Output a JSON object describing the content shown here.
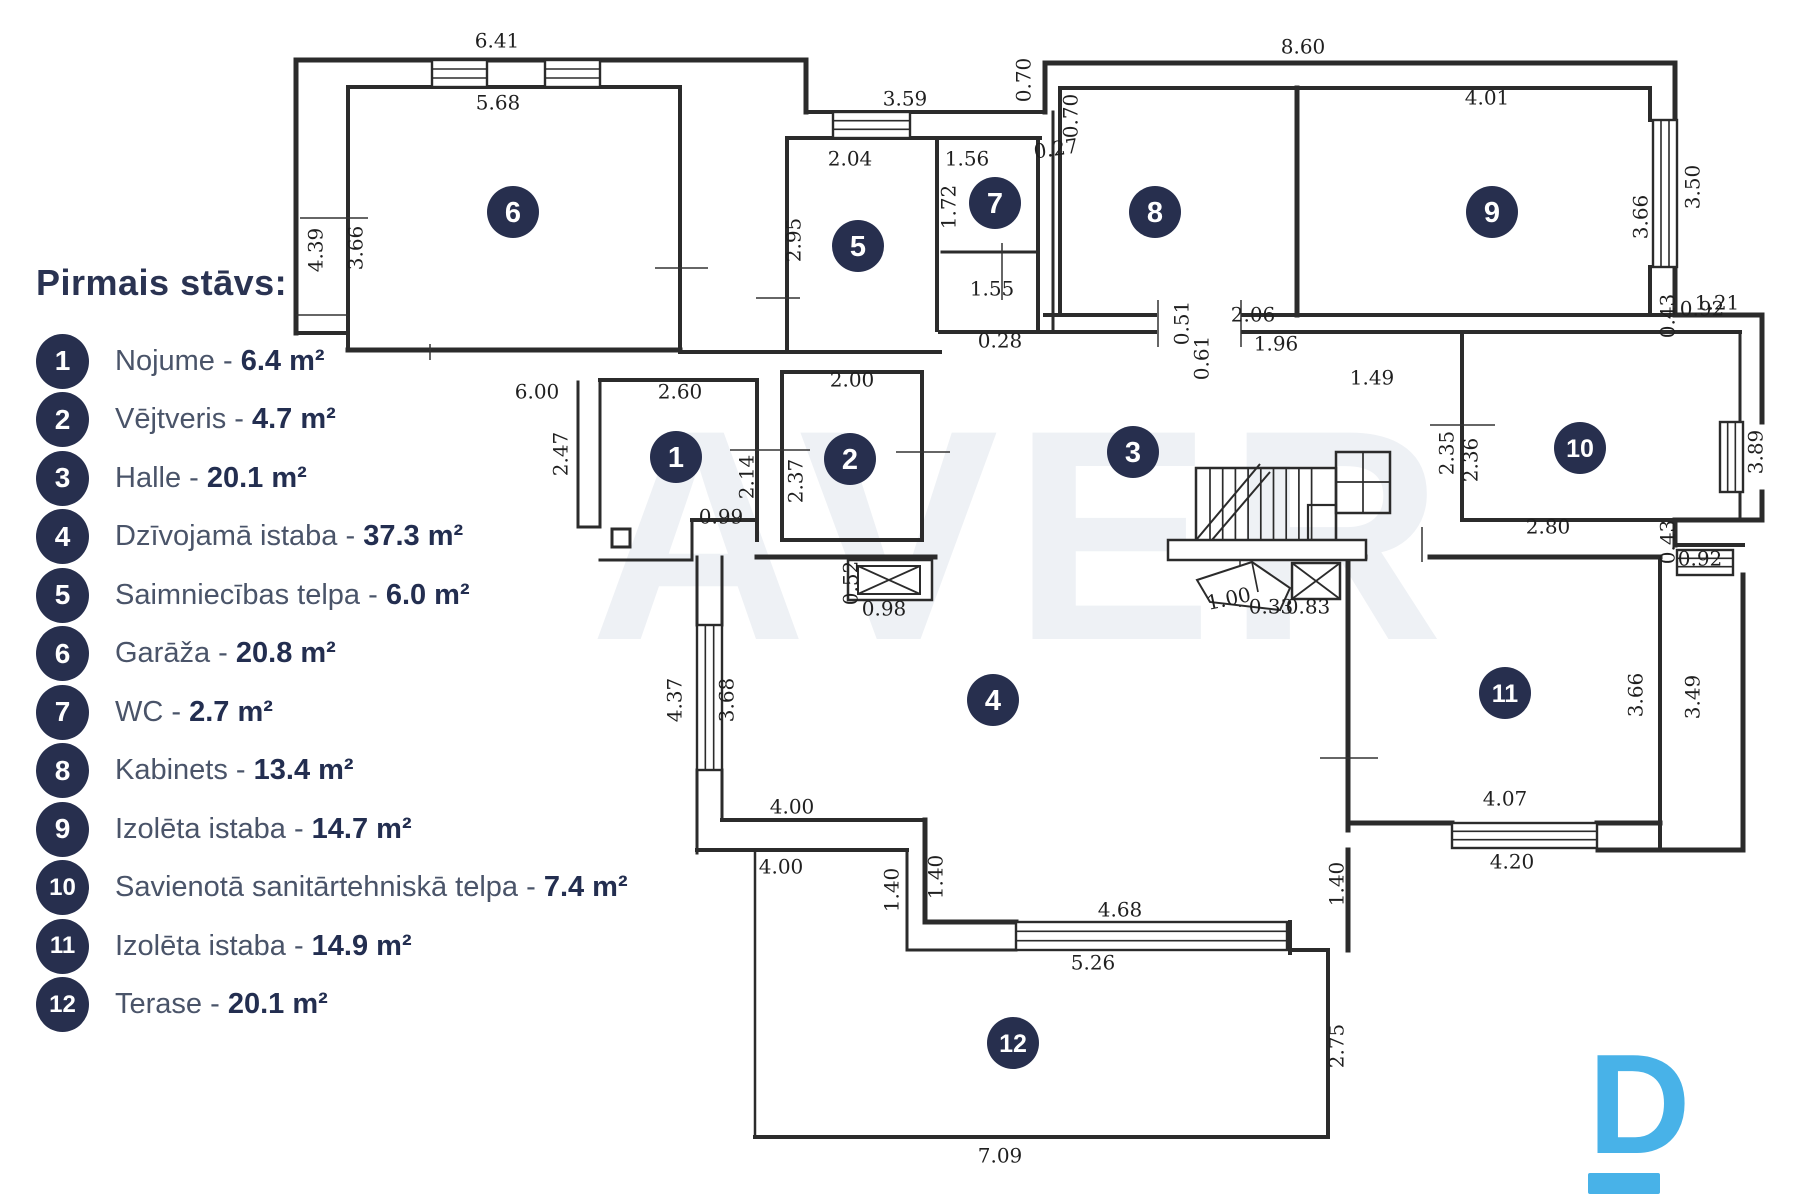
{
  "legend": {
    "title": "Pirmais stāvs:",
    "separator": " - ",
    "items": [
      {
        "num": "1",
        "name": "Nojume",
        "area": "6.4 m²"
      },
      {
        "num": "2",
        "name": "Vējtveris",
        "area": "4.7 m²"
      },
      {
        "num": "3",
        "name": "Halle",
        "area": "20.1 m²"
      },
      {
        "num": "4",
        "name": "Dzīvojamā istaba",
        "area": "37.3 m²"
      },
      {
        "num": "5",
        "name": "Saimniecības telpa",
        "area": "6.0 m²"
      },
      {
        "num": "6",
        "name": "Garāža",
        "area": "20.8 m²"
      },
      {
        "num": "7",
        "name": "WC",
        "area": "2.7 m²"
      },
      {
        "num": "8",
        "name": "Kabinets",
        "area": "13.4 m²"
      },
      {
        "num": "9",
        "name": "Izolēta istaba",
        "area": "14.7 m²"
      },
      {
        "num": "10",
        "name": "Savienotā sanitārtehniskā telpa",
        "area": "7.4 m²"
      },
      {
        "num": "11",
        "name": "Izolēta istaba",
        "area": "14.9 m²"
      },
      {
        "num": "12",
        "name": "Terase",
        "area": "20.1 m²"
      }
    ]
  },
  "watermark": {
    "text": "AVER"
  },
  "logo": {
    "letter": "D"
  },
  "colors": {
    "navy": "#272f4e",
    "line": "#2b2b2b",
    "watermark": "#eef1f5",
    "logo_blue": "#48b2e8"
  },
  "plan": {
    "badges": [
      {
        "n": "1",
        "x": 676,
        "y": 457
      },
      {
        "n": "2",
        "x": 850,
        "y": 459
      },
      {
        "n": "3",
        "x": 1133,
        "y": 452
      },
      {
        "n": "4",
        "x": 993,
        "y": 700
      },
      {
        "n": "5",
        "x": 858,
        "y": 246
      },
      {
        "n": "6",
        "x": 513,
        "y": 212
      },
      {
        "n": "7",
        "x": 995,
        "y": 203
      },
      {
        "n": "8",
        "x": 1155,
        "y": 212
      },
      {
        "n": "9",
        "x": 1492,
        "y": 212
      },
      {
        "n": "10",
        "x": 1580,
        "y": 448
      },
      {
        "n": "11",
        "x": 1505,
        "y": 693
      },
      {
        "n": "12",
        "x": 1013,
        "y": 1043
      }
    ],
    "dims": [
      {
        "t": "6.41",
        "x": 497,
        "y": 42
      },
      {
        "t": "5.68",
        "x": 498,
        "y": 104
      },
      {
        "t": "3.59",
        "x": 905,
        "y": 100
      },
      {
        "t": "2.04",
        "x": 850,
        "y": 160
      },
      {
        "t": "1.56",
        "x": 967,
        "y": 160
      },
      {
        "t": "0.70",
        "x": 1025,
        "y": 80,
        "r": 90
      },
      {
        "t": "0.70",
        "x": 1072,
        "y": 116,
        "r": 90
      },
      {
        "t": "0.27",
        "x": 1056,
        "y": 150,
        "r": -8
      },
      {
        "t": "8.60",
        "x": 1303,
        "y": 48
      },
      {
        "t": "4.01",
        "x": 1487,
        "y": 99
      },
      {
        "t": "4.39",
        "x": 317,
        "y": 250,
        "r": 90
      },
      {
        "t": "3.66",
        "x": 357,
        "y": 248,
        "r": 90
      },
      {
        "t": "2.95",
        "x": 795,
        "y": 240,
        "r": 90
      },
      {
        "t": "1.72",
        "x": 950,
        "y": 207,
        "r": 90
      },
      {
        "t": "1.55",
        "x": 992,
        "y": 290
      },
      {
        "t": "0.28",
        "x": 1000,
        "y": 342
      },
      {
        "t": "0.51",
        "x": 1183,
        "y": 323,
        "r": 90
      },
      {
        "t": "0.61",
        "x": 1203,
        "y": 358,
        "r": 90
      },
      {
        "t": "2.06",
        "x": 1253,
        "y": 316
      },
      {
        "t": "1.96",
        "x": 1276,
        "y": 345
      },
      {
        "t": "1.49",
        "x": 1372,
        "y": 379
      },
      {
        "t": "3.66",
        "x": 1642,
        "y": 217,
        "r": 90
      },
      {
        "t": "3.50",
        "x": 1694,
        "y": 187,
        "r": 90
      },
      {
        "t": "1.21",
        "x": 1717,
        "y": 304
      },
      {
        "t": "0.43",
        "x": 1669,
        "y": 316,
        "r": 90
      },
      {
        "t": "0.92",
        "x": 1702,
        "y": 310
      },
      {
        "t": "2.35",
        "x": 1448,
        "y": 453,
        "r": 90
      },
      {
        "t": "2.36",
        "x": 1472,
        "y": 460,
        "r": 90
      },
      {
        "t": "2.80",
        "x": 1548,
        "y": 528
      },
      {
        "t": "3.89",
        "x": 1757,
        "y": 452,
        "r": 90
      },
      {
        "t": "0.43",
        "x": 1669,
        "y": 542,
        "r": 90
      },
      {
        "t": "0.92",
        "x": 1700,
        "y": 560
      },
      {
        "t": "6.00",
        "x": 537,
        "y": 393
      },
      {
        "t": "2.60",
        "x": 680,
        "y": 393
      },
      {
        "t": "2.00",
        "x": 852,
        "y": 381
      },
      {
        "t": "2.47",
        "x": 562,
        "y": 454,
        "r": 90
      },
      {
        "t": "2.14",
        "x": 748,
        "y": 477,
        "r": 90
      },
      {
        "t": "2.37",
        "x": 797,
        "y": 481,
        "r": 90
      },
      {
        "t": "0.99",
        "x": 721,
        "y": 518
      },
      {
        "t": "0.52",
        "x": 852,
        "y": 583,
        "r": 90
      },
      {
        "t": "0.98",
        "x": 884,
        "y": 610
      },
      {
        "t": "1.00",
        "x": 1229,
        "y": 600,
        "r": -12
      },
      {
        "t": "0.33",
        "x": 1271,
        "y": 608
      },
      {
        "t": "0.83",
        "x": 1308,
        "y": 608
      },
      {
        "t": "4.37",
        "x": 676,
        "y": 700,
        "r": 90
      },
      {
        "t": "3.68",
        "x": 728,
        "y": 700,
        "r": 90
      },
      {
        "t": "4.00",
        "x": 792,
        "y": 808
      },
      {
        "t": "4.00",
        "x": 781,
        "y": 868
      },
      {
        "t": "1.40",
        "x": 893,
        "y": 890,
        "r": 90
      },
      {
        "t": "1.40",
        "x": 937,
        "y": 877,
        "r": 90
      },
      {
        "t": "4.68",
        "x": 1120,
        "y": 911
      },
      {
        "t": "5.26",
        "x": 1093,
        "y": 964
      },
      {
        "t": "4.07",
        "x": 1505,
        "y": 800
      },
      {
        "t": "4.20",
        "x": 1512,
        "y": 863
      },
      {
        "t": "3.66",
        "x": 1637,
        "y": 695,
        "r": 90
      },
      {
        "t": "3.49",
        "x": 1694,
        "y": 697,
        "r": 90
      },
      {
        "t": "1.40",
        "x": 1338,
        "y": 884,
        "r": 90
      },
      {
        "t": "2.75",
        "x": 1338,
        "y": 1046,
        "r": 90
      },
      {
        "t": "7.09",
        "x": 1000,
        "y": 1157
      }
    ]
  }
}
